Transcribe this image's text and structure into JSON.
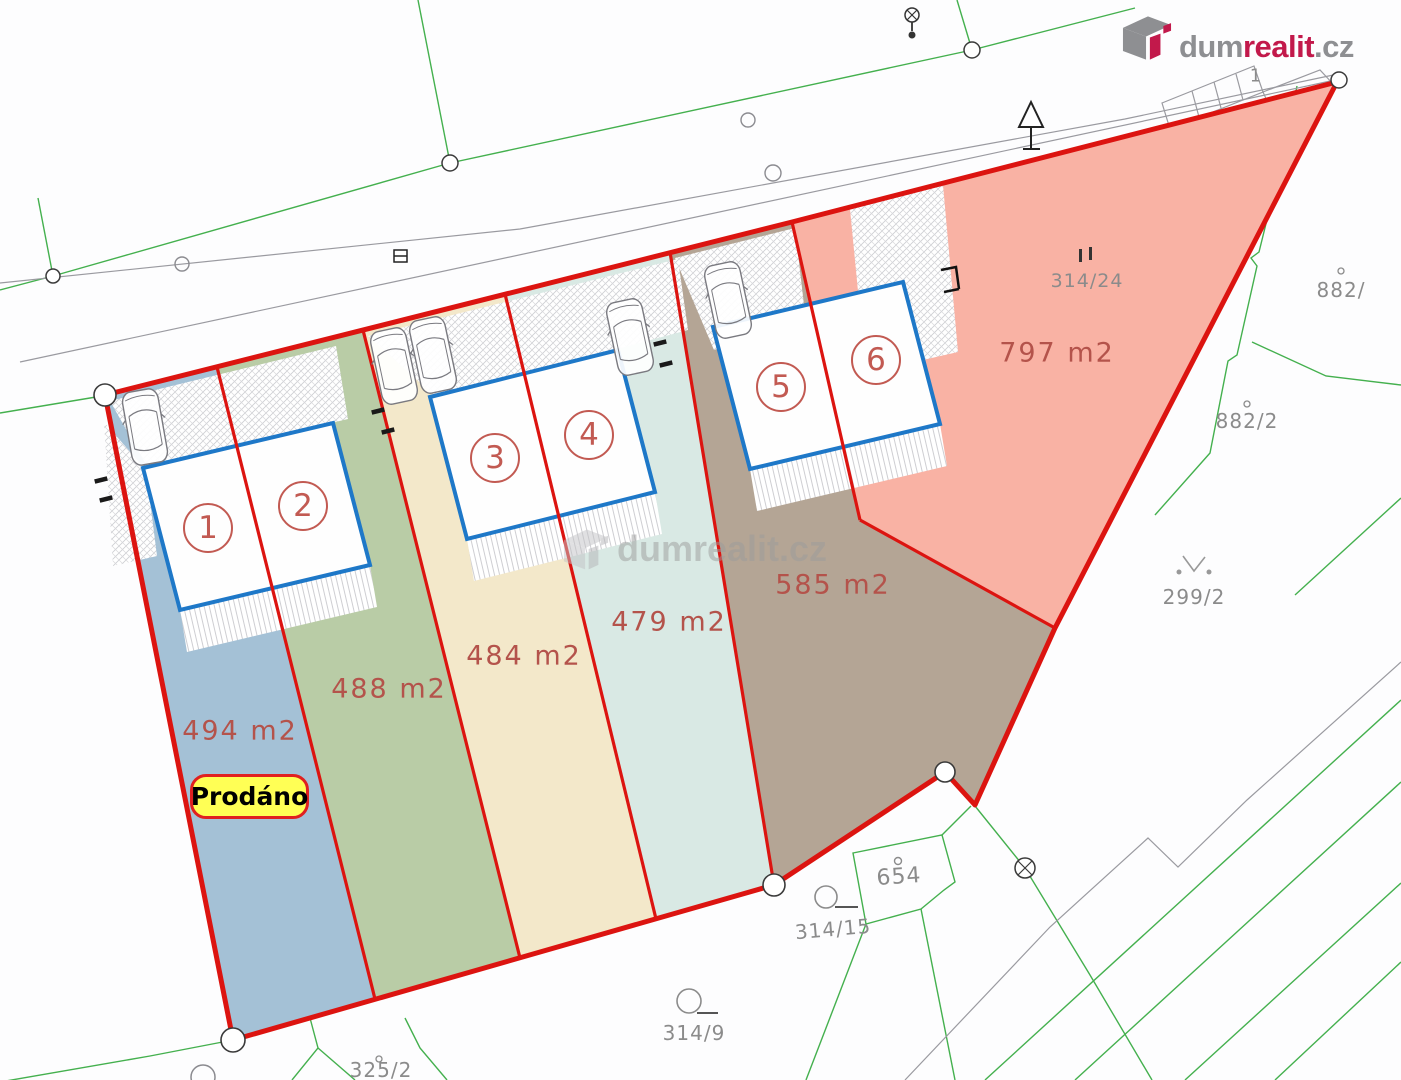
{
  "brand": {
    "dum": "dum",
    "realit": "realit",
    "cz": ".cz"
  },
  "watermark": {
    "text": "dumrealit.cz"
  },
  "badge": {
    "label": "Prodáno"
  },
  "plots": [
    {
      "number": "1",
      "area": "494 m2",
      "color": "#a4c1d6"
    },
    {
      "number": "2",
      "area": "488 m2",
      "color": "#b9cca6"
    },
    {
      "number": "3",
      "area": "484 m2",
      "color": "#f3e8ca"
    },
    {
      "number": "4",
      "area": "479 m2",
      "color": "#d9e9e4"
    },
    {
      "number": "5",
      "area": "585 m2",
      "color": "#b4a595"
    },
    {
      "number": "6",
      "area": "797 m2",
      "color": "#f9b2a4"
    }
  ],
  "parcels": {
    "p314_24": "314/24",
    "p882": "882/",
    "p882_2": "882/2",
    "p299_2": "299/2",
    "p654": "654",
    "p314_15": "314/15",
    "p314_9": "314/9",
    "p325_2": "325/2",
    "p1": "1"
  },
  "colors": {
    "boundary_red": "#dc1410",
    "building_blue": "#1e78c8",
    "green_line": "#44b04e",
    "gray_line": "#9a9aa0",
    "area_text": "#b4534b",
    "parcel_text": "#8b8b8b",
    "brand_red": "#c2194b",
    "brand_gray": "#8e8f92",
    "badge_yellow": "#ffff55",
    "badge_border": "#e02020"
  }
}
